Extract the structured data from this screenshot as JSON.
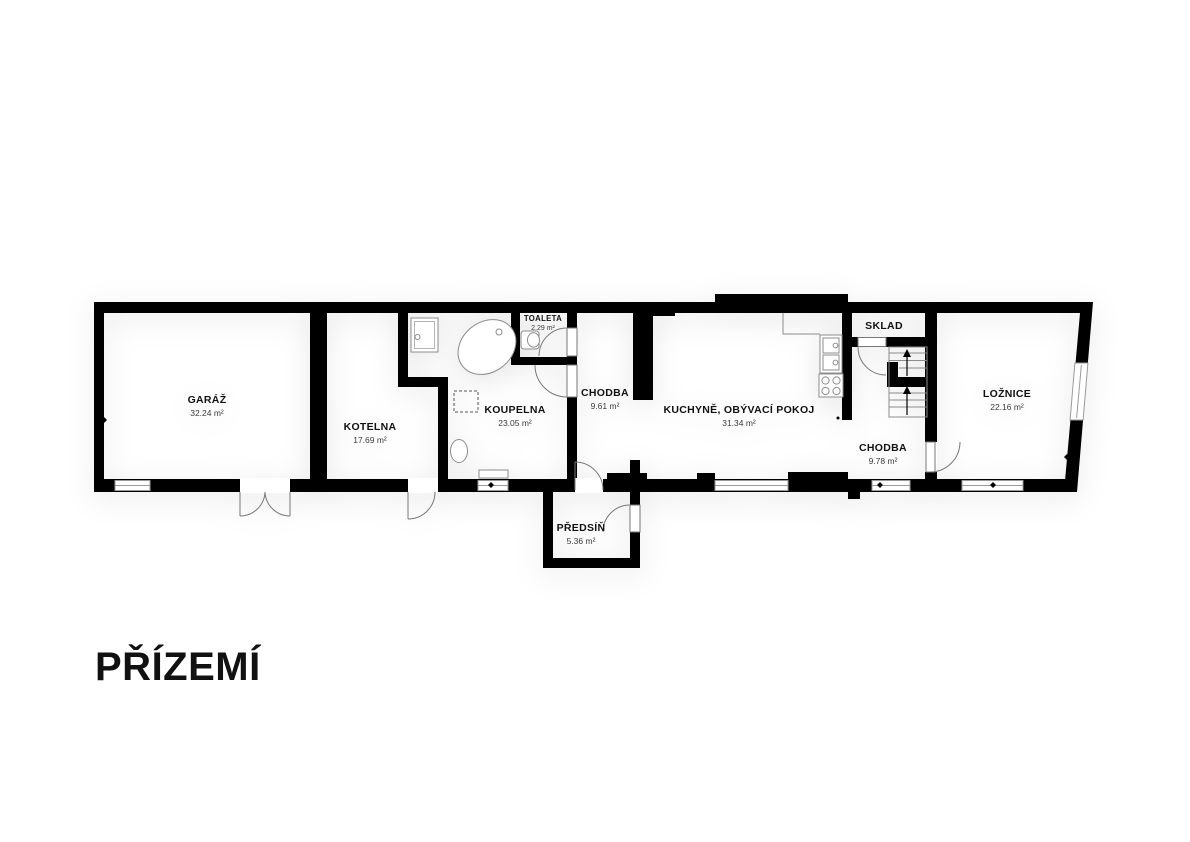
{
  "floor_title": "PŘÍZEMÍ",
  "rooms": [
    {
      "name": "GARÁŽ",
      "area": "32.24 m²"
    },
    {
      "name": "KOTELNA",
      "area": "17.69 m²"
    },
    {
      "name": "KOUPELNA",
      "area": "23.05 m²"
    },
    {
      "name": "TOALETA",
      "area": "2.29 m²"
    },
    {
      "name": "CHODBA",
      "area": "9.61 m²"
    },
    {
      "name": "KUCHYNĚ, OBÝVACÍ POKOJ",
      "area": "31.34 m²"
    },
    {
      "name": "SKLAD",
      "area": ""
    },
    {
      "name": "CHODBA",
      "area": "9.78 m²"
    },
    {
      "name": "LOŽNICE",
      "area": "22.16 m²"
    },
    {
      "name": "PŘEDSÍŇ",
      "area": "5.36 m²"
    }
  ],
  "colors": {
    "wall": "#000000",
    "fixture_outline": "#8c8c8c",
    "door_arc": "#777777",
    "window_line": "#9a9a9a",
    "text": "#111111"
  }
}
